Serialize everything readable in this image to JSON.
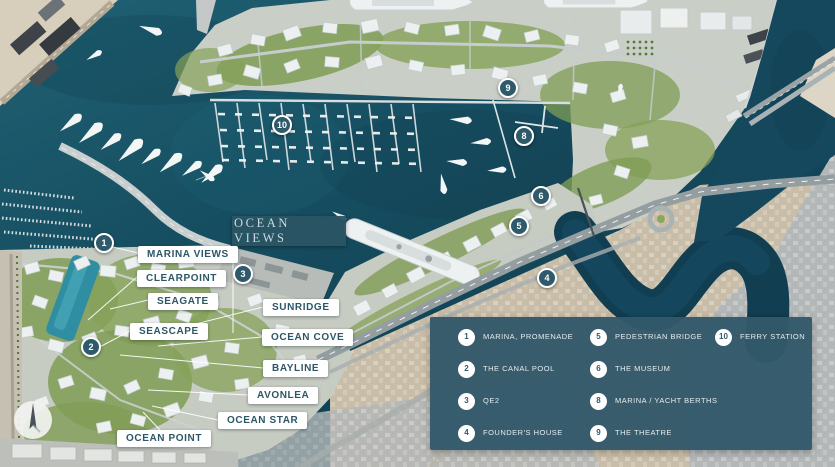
{
  "map": {
    "title_badge": {
      "text": "OCEAN VIEWS"
    },
    "labels": [
      {
        "id": "marina-views",
        "text": "MARINA VIEWS",
        "x": 138,
        "y": 246
      },
      {
        "id": "clearpoint",
        "text": "CLEARPOINT",
        "x": 137,
        "y": 270
      },
      {
        "id": "seagate",
        "text": "SEAGATE",
        "x": 148,
        "y": 293
      },
      {
        "id": "seascape",
        "text": "SEASCAPE",
        "x": 130,
        "y": 323
      },
      {
        "id": "sunridge",
        "text": "SUNRIDGE",
        "x": 263,
        "y": 299
      },
      {
        "id": "ocean-cove",
        "text": "OCEAN COVE",
        "x": 262,
        "y": 329
      },
      {
        "id": "bayline",
        "text": "BAYLINE",
        "x": 263,
        "y": 360
      },
      {
        "id": "avonlea",
        "text": "AVONLEA",
        "x": 248,
        "y": 387
      },
      {
        "id": "ocean-star",
        "text": "OCEAN STAR",
        "x": 218,
        "y": 412
      },
      {
        "id": "ocean-point",
        "text": "OCEAN POINT",
        "x": 117,
        "y": 430
      }
    ],
    "markers": [
      {
        "n": "1",
        "x": 104,
        "y": 243
      },
      {
        "n": "2",
        "x": 91,
        "y": 347
      },
      {
        "n": "3",
        "x": 243,
        "y": 274
      },
      {
        "n": "4",
        "x": 547,
        "y": 278
      },
      {
        "n": "5",
        "x": 519,
        "y": 226
      },
      {
        "n": "6",
        "x": 541,
        "y": 196
      },
      {
        "n": "8",
        "x": 524,
        "y": 136
      },
      {
        "n": "9",
        "x": 508,
        "y": 88
      },
      {
        "n": "10",
        "x": 282,
        "y": 125
      }
    ]
  },
  "legend": {
    "columns": [
      {
        "items": [
          {
            "n": "1",
            "label": "MARINA, PROMENADE"
          },
          {
            "n": "2",
            "label": "THE CANAL POOL"
          },
          {
            "n": "3",
            "label": "QE2"
          },
          {
            "n": "4",
            "label": "FOUNDER'S HOUSE"
          }
        ]
      },
      {
        "items": [
          {
            "n": "5",
            "label": "PEDESTRIAN BRIDGE"
          },
          {
            "n": "6",
            "label": "THE MUSEUM"
          },
          {
            "n": "8",
            "label": "MARINA / YACHT BERTHS"
          },
          {
            "n": "9",
            "label": "THE THEATRE"
          }
        ]
      },
      {
        "items": [
          {
            "n": "10",
            "label": "FERRY STATION"
          }
        ]
      }
    ]
  },
  "colors": {
    "panel_teal": "#33596a",
    "marker_teal": "#2e5a6b",
    "label_text": "#2d5766",
    "water_deep": "#0f3c4f",
    "water_light": "#1f6173",
    "sand": "#d7cebc",
    "city_beige": "#cbc0ab",
    "city_gray": "#b6babb",
    "greenery": "#7f9c55"
  }
}
